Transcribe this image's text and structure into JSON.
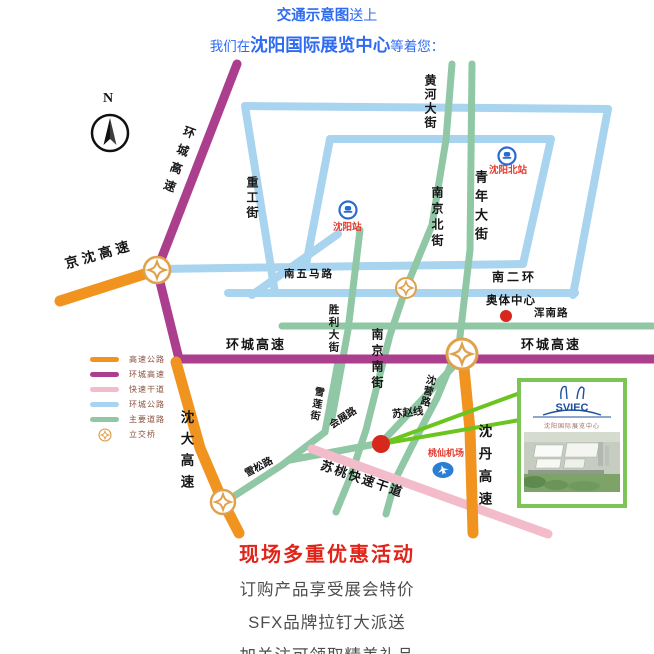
{
  "header": {
    "line1_bold": "交通示意图",
    "line1_rest": "送上",
    "line2_pre": "我们在",
    "line2_bold": "沈阳国际展览中心",
    "line2_post": "等着您："
  },
  "map": {
    "compass": "N",
    "legend": [
      "高速公路",
      "环城高速",
      "快速干道",
      "环城公路",
      "主要道路",
      "立交桥"
    ],
    "labels": {
      "jingshen": "京沈高速",
      "huancheng_gaosu": "环城高速",
      "shenda_gaosu": "沈大高速",
      "shendan_gaosu": "沈丹高速",
      "zhonggong": "重工街",
      "huanghe": "黄河大街",
      "qingnian": "青年大街",
      "nanjingbei": "南京北街",
      "nanjingnan": "南京南街",
      "shengli": "胜利大街",
      "nanwuma": "南五马路",
      "nanerhuan": "南二环",
      "aoti": "奥体中心",
      "hunnan": "浑南路",
      "shenying": "沈营路",
      "suzhao": "苏赵线",
      "huizhan": "会展路",
      "xuelian": "雪莲街",
      "xuesong": "雪松路",
      "sutao": "苏桃快速干道",
      "taoxian": "桃仙机场"
    },
    "stations": [
      "沈阳站",
      "沈阳北站"
    ],
    "sviec": {
      "logo": "SVIEC",
      "name": "沈阳国际展览中心"
    }
  },
  "footer": {
    "title": "现场多重优惠活动",
    "lines": [
      "订购产品享受展会特价",
      "SFX品牌拉钉大派送",
      "加关注可领取精美礼品"
    ]
  },
  "colors": {
    "expressway_orange": "#F0941F",
    "ring_expressway_magenta": "#AC3E8E",
    "fast_road_pink": "#F3BCCA",
    "ring_road_blue": "#A9D4EF",
    "main_road_green": "#90C7A4",
    "route_line_green": "#6CC41E",
    "marker_red": "#D8281E",
    "station_blue": "#2A6AD1",
    "header_blue": "#2E6BF0",
    "footer_title_red": "#E02419"
  }
}
